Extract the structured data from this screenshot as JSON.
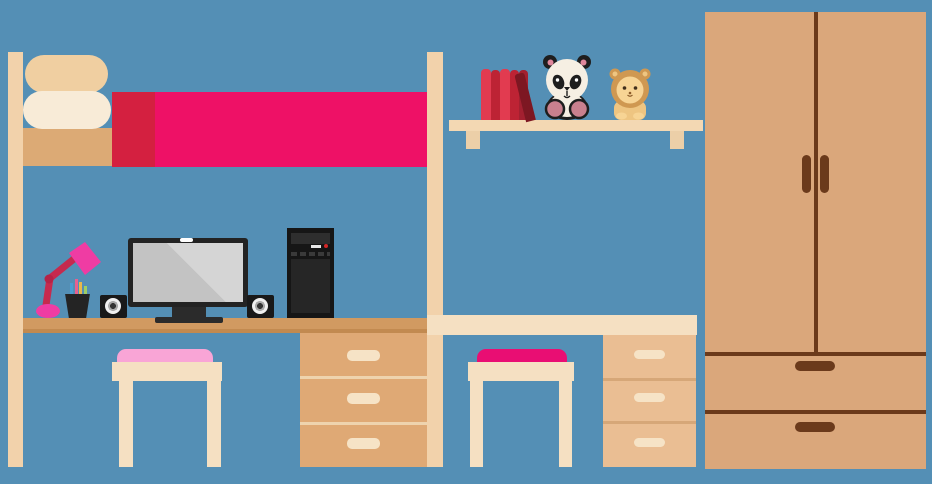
{
  "scene": {
    "description": "flat vector illustration of a kids bedroom with loft bed, two desks, wall shelf with plush toys, and wardrobe",
    "width": 932,
    "height": 484
  },
  "palette": {
    "background": "#548fb5",
    "wood_cream": "#f2d2ab",
    "wood_cream_light": "#f6e3c6",
    "pillow_back": "#f0cfa1",
    "pillow_front": "#f8ebd7",
    "mattress": "#dcaa75",
    "blanket_pink": "#ee1166",
    "blanket_fold_red": "#d42040",
    "desk_left_top": "#d19a61",
    "desk_left_edge": "#c28a50",
    "drawers_left": "#dfa975",
    "drawers_left_divider": "#eed3ae",
    "drawers_right": "#eabe93",
    "drawers_right_divider": "#d6a778",
    "desk_right_top": "#f5e0c2",
    "shelf_board": "#f3d8b3",
    "shelf_bracket": "#eccfa8",
    "stool_left_cushion": "#f9a5d6",
    "stool_right_cushion": "#e90e73",
    "wardrobe_body": "#daa77b",
    "wardrobe_trim": "#6b3a1b",
    "lamp_pink": "#ef3ca3",
    "lamp_arm": "#c62a4e",
    "lamp_elbow": "#b52347",
    "device_black": "#191919",
    "monitor_screen_gray": "#c9c9c9",
    "book_red_bright": "#e23b50",
    "book_red_dark": "#bd2334",
    "book_maroon": "#a32030",
    "book_leaning": "#7d1722",
    "panda_fur_light": "#f6efe3",
    "panda_dark": "#1e1e1e",
    "panda_ear_pink": "#e0879c",
    "panda_feet": "#c9808e",
    "panda_eye_white": "#ffffff",
    "lion_mane": "#cf9851",
    "lion_face": "#f7d494",
    "lion_body": "#eec581",
    "lion_eyes": "#42301c",
    "lion_mouth": "#8a5a28",
    "pencil_blue": "#4a9fd4",
    "pencil_pink": "#e8608f",
    "pencil_yellow": "#e8b84b",
    "pencil_green": "#9fcf63",
    "tower_power_light": "#d22727"
  },
  "objects": [
    {
      "name": "loft-bed",
      "parts": [
        "left post",
        "right post",
        "tan mattress",
        "two stacked pillows",
        "pink blanket with dark red fold"
      ]
    },
    {
      "name": "desk-left",
      "parts": [
        "tan desktop",
        "three-drawer unit with cream pill handles"
      ]
    },
    {
      "name": "stool-left",
      "cushion_color": "#f9a5d6"
    },
    {
      "name": "desk-lamp",
      "shade_color": "#ef3ca3",
      "arm_color": "#c62a4e"
    },
    {
      "name": "pencil-cup",
      "pencil_colors": [
        "#4a9fd4",
        "#e8608f",
        "#e8b84b",
        "#9fcf63"
      ]
    },
    {
      "name": "speakers",
      "count": 2
    },
    {
      "name": "monitor",
      "details": [
        "webcam notch",
        "diagonal screen highlight",
        "stand"
      ]
    },
    {
      "name": "pc-tower",
      "details": [
        "top panel",
        "power light",
        "vent dashes",
        "side panel"
      ]
    },
    {
      "name": "wall-shelf",
      "items": [
        "five upright red books",
        "one leaning maroon book",
        "panda plush",
        "lion plush"
      ],
      "brackets": 2
    },
    {
      "name": "desk-right",
      "parts": [
        "cream desktop",
        "three-drawer unit with cream pill handles"
      ]
    },
    {
      "name": "stool-right",
      "cushion_color": "#e90e73"
    },
    {
      "name": "wardrobe",
      "parts": [
        "two doors with center split",
        "two vertical door handles",
        "two drawers with horizontal handles"
      ]
    }
  ],
  "books": {
    "upright_colors": [
      "#e23b50",
      "#bd2334",
      "#e23b50",
      "#bd2334",
      "#a32030"
    ],
    "leaning_color": "#7d1722"
  }
}
